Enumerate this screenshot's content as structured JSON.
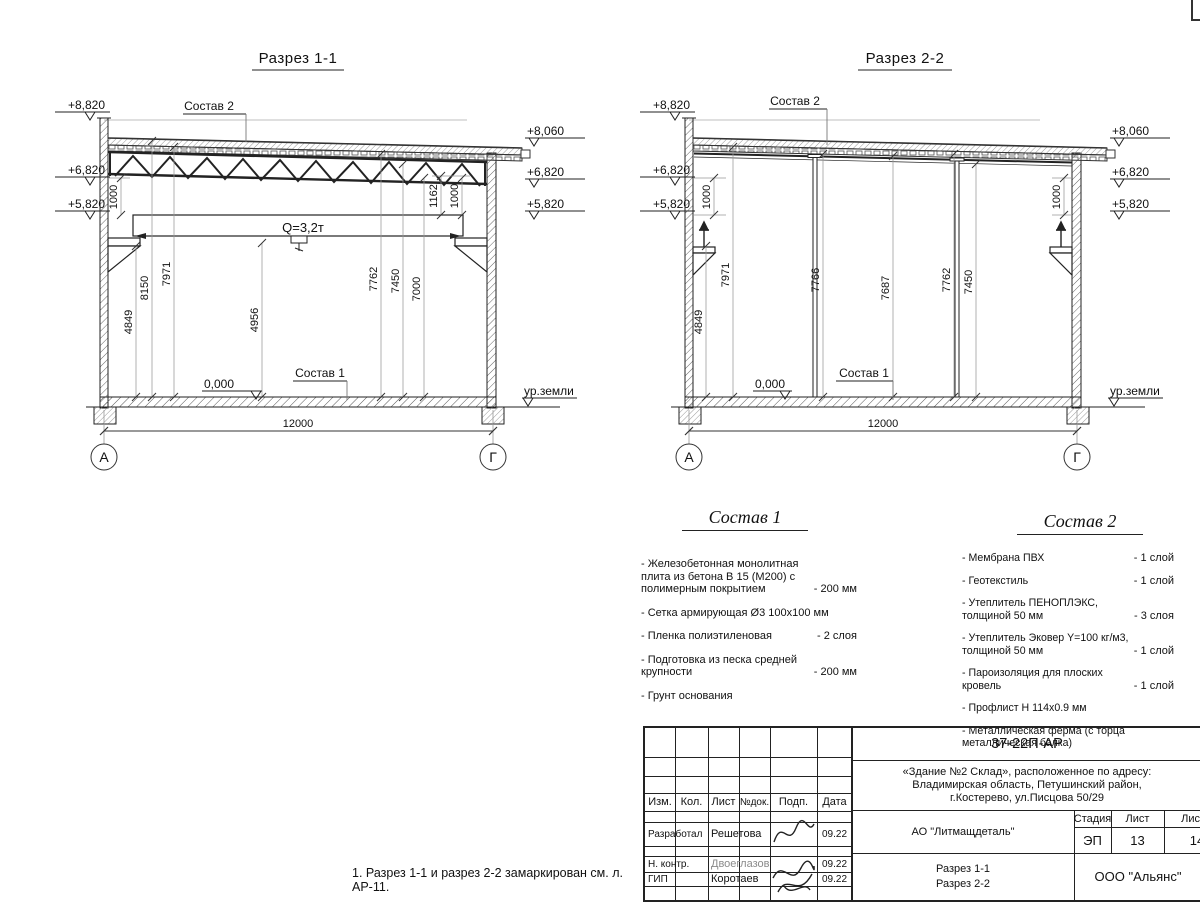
{
  "page": {
    "note": "1. Разрез 1-1 и разрез 2-2 замаркирован см. л. АР-11."
  },
  "section1": {
    "title": "Разрез 1-1",
    "levels_left": [
      "+8,820",
      "+6,820",
      "+5,820"
    ],
    "levels_right": [
      "+8,060",
      "+6,820",
      "+5,820"
    ],
    "roof_callout": "Состав 2",
    "floor_callout": "Состав 1",
    "crane_capacity": "Q=3,2т",
    "zero_level": "0,000",
    "ground_level": "ур.земли",
    "span": "12000",
    "axis_left": "А",
    "axis_right": "Г",
    "vdims": [
      "4849",
      "8150",
      "7971",
      "4956",
      "7762",
      "7450",
      "7000"
    ],
    "side_dims": [
      "1000",
      "1162",
      "1000"
    ]
  },
  "section2": {
    "title": "Разрез 2-2",
    "levels_left": [
      "+8,820",
      "+6,820",
      "+5,820"
    ],
    "levels_right": [
      "+8,060",
      "+6,820",
      "+5,820"
    ],
    "roof_callout": "Состав 2",
    "floor_callout": "Состав 1",
    "zero_level": "0,000",
    "ground_level": "ур.земли",
    "span": "12000",
    "axis_left": "А",
    "axis_right": "Г",
    "vdims": [
      "4849",
      "7971",
      "7766",
      "7687",
      "7762",
      "7450"
    ],
    "side_dims": [
      "1000",
      "1000"
    ]
  },
  "sostav1": {
    "title": "Состав 1",
    "items": [
      {
        "name": "- Железобетонная  монолитная плита из бетона В 15 (М200) с полимерным покрытием",
        "qty": "- 200 мм"
      },
      {
        "name": "- Сетка армирующая Ø3 100х100 мм",
        "qty": ""
      },
      {
        "name": "- Пленка полиэтиленовая",
        "qty": "- 2 слоя"
      },
      {
        "name": "- Подготовка из песка средней крупности",
        "qty": "- 200 мм"
      },
      {
        "name": "- Грунт основания",
        "qty": ""
      }
    ]
  },
  "sostav2": {
    "title": "Состав 2",
    "items": [
      {
        "name": "- Мембрана ПВХ",
        "qty": "- 1 слой"
      },
      {
        "name": "- Геотекстиль",
        "qty": "- 1 слой"
      },
      {
        "name": "- Утеплитель ПЕНОПЛЭКС, толщиной 50 мм",
        "qty": "- 3 слоя"
      },
      {
        "name": "- Утеплитель Эковер Y=100 кг/м3, толщиной 50 мм",
        "qty": "- 1 слой"
      },
      {
        "name": "- Пароизоляция для плоских кровель",
        "qty": "- 1 слой"
      },
      {
        "name": "- Профлист Н 114х0.9 мм",
        "qty": ""
      },
      {
        "name": "- Металлическая ферма (с торца металлическая балка)",
        "qty": ""
      }
    ]
  },
  "stamp": {
    "doc_code": "37-22П-АР",
    "project_line1": "«Здание №2 Склад», расположенное по адресу:",
    "project_line2": "Владимирская область, Петушинский район,",
    "project_line3": "г.Костерево, ул.Писцова 50/29",
    "col_izm": "Изм.",
    "col_kol": "Кол.",
    "col_list": "Лист",
    "col_ndok": "№док.",
    "col_podp": "Подп.",
    "col_data": "Дата",
    "rows": [
      {
        "role": "Разработал",
        "name": "Решетова",
        "date": "09.22"
      },
      {
        "role": "Н. контр.",
        "name": "Двоеглазов",
        "date": "09.22"
      },
      {
        "role": "ГИП",
        "name": "Коротаев",
        "date": "09.22"
      }
    ],
    "company": "АО \"Литмащдеталь\"",
    "stage_label": "Стадия",
    "sheet_label": "Лист",
    "sheets_label": "Листов",
    "stage": "ЭП",
    "sheet_num": "13",
    "sheets_total": "14",
    "content_line1": "Разрез 1-1",
    "content_line2": "Разрез 2-2",
    "org": "ООО \"Альянс\""
  }
}
